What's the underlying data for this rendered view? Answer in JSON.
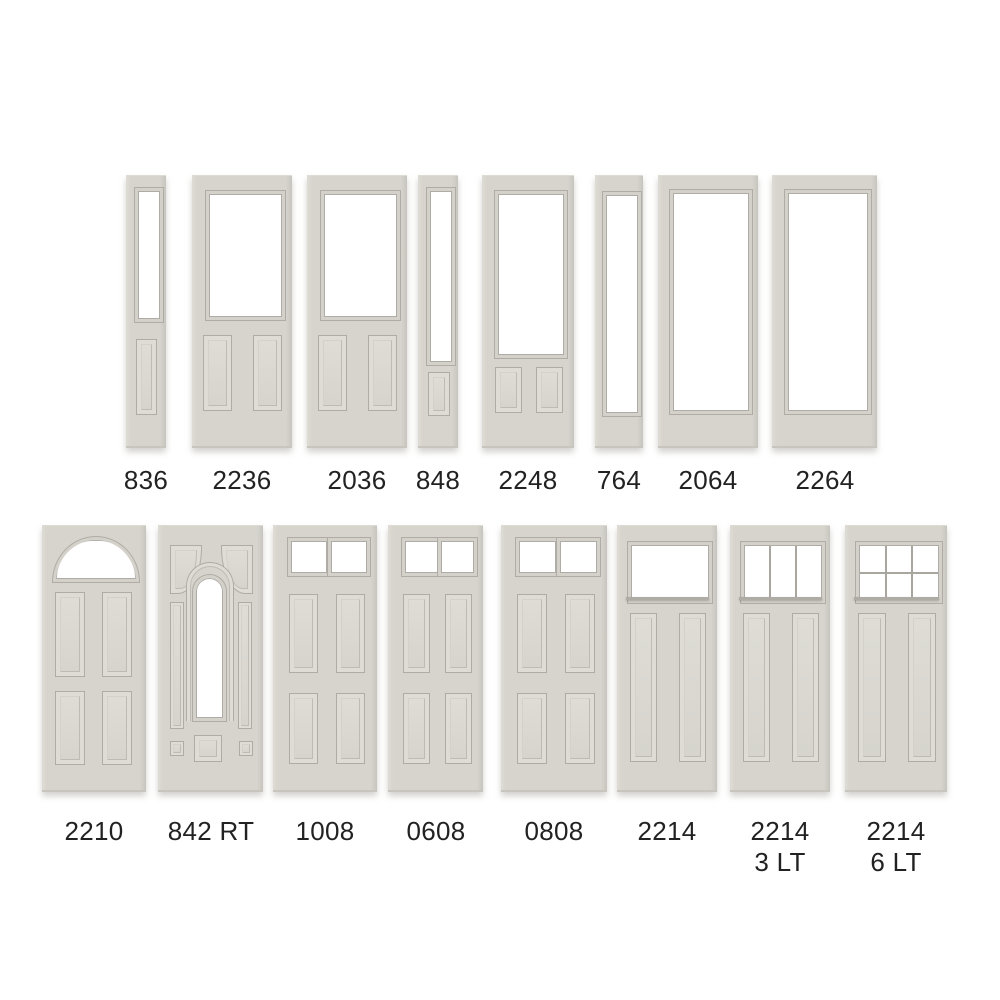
{
  "palette": {
    "door": "#d6d4cd",
    "door_light": "#dedcd5",
    "door_dark": "#c7c5be",
    "molding": "#d3d1c9",
    "line": "#aeaca4",
    "line_soft": "#bdbbb3",
    "muntin": "#a8a69e",
    "glass": "#ffffff",
    "text": "#222222",
    "background": "#ffffff"
  },
  "rows": [
    {
      "name": "top-row",
      "door_top": 175,
      "door_height": 273,
      "label_top": 465,
      "doors": [
        {
          "label": "836",
          "style": "sidelight-half",
          "x": 126,
          "w": 40
        },
        {
          "label": "2236",
          "style": "half-2panel",
          "x": 192,
          "w": 100
        },
        {
          "label": "2036",
          "style": "half-2panel",
          "x": 307,
          "w": 100
        },
        {
          "label": "848",
          "style": "sidelight-3q",
          "x": 418,
          "w": 40
        },
        {
          "label": "2248",
          "style": "3q-2panel",
          "x": 482,
          "w": 92
        },
        {
          "label": "764",
          "style": "sidelight-full",
          "x": 595,
          "w": 48
        },
        {
          "label": "2064",
          "style": "full-lite",
          "x": 658,
          "w": 100
        },
        {
          "label": "2264",
          "style": "full-lite",
          "x": 772,
          "w": 105
        }
      ]
    },
    {
      "name": "bottom-row",
      "door_top": 525,
      "door_height": 267,
      "label_top": 816,
      "doors": [
        {
          "label": "2210",
          "style": "fan-4panel",
          "x": 42,
          "w": 104
        },
        {
          "label": "842 RT",
          "style": "arch-rt",
          "x": 158,
          "w": 105
        },
        {
          "label": "1008",
          "style": "2lite-4panel",
          "x": 273,
          "w": 104
        },
        {
          "label": "0608",
          "style": "2lite-4panel",
          "x": 388,
          "w": 95
        },
        {
          "label": "0808",
          "style": "2lite-4panel",
          "x": 501,
          "w": 106
        },
        {
          "label": "2214",
          "style": "craftsman-1",
          "x": 617,
          "w": 100
        },
        {
          "label": "2214",
          "sublabel": "3 LT",
          "style": "craftsman-3",
          "x": 730,
          "w": 100
        },
        {
          "label": "2214",
          "sublabel": "6 LT",
          "style": "craftsman-6",
          "x": 845,
          "w": 102
        }
      ]
    }
  ]
}
